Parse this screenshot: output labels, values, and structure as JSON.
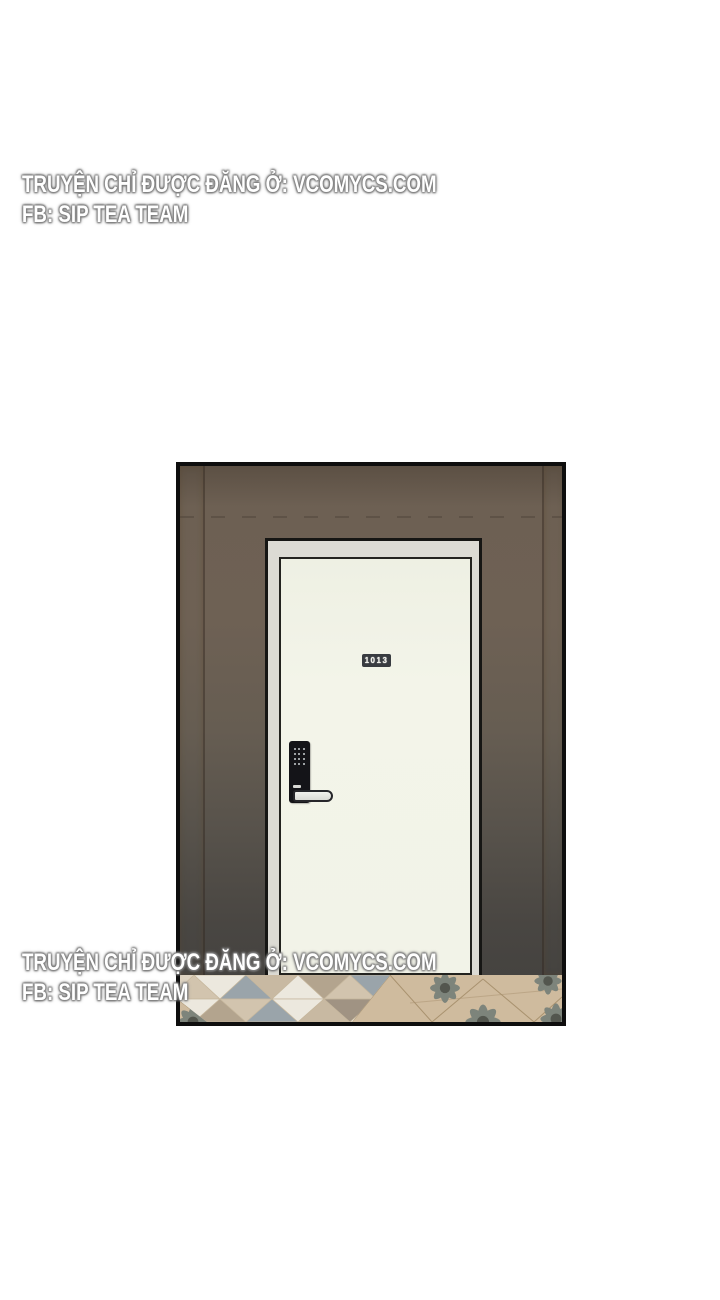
{
  "watermark": {
    "line1": "TRUYỆN CHỈ ĐƯỢC ĐĂNG Ở: VCOMYCS.COM",
    "line2": "FB: SIP TEA TEAM",
    "text_color": "#ffffff",
    "glow_color": "#7d7d7d"
  },
  "panel": {
    "description": "single comic panel: apartment hallway door with keypad lock",
    "border_color": "#0e0e0e",
    "wall_top_color": "#6e6154",
    "wall_bottom_color": "#454340",
    "wood_pillar_light": "#e8dcc6",
    "wood_pillar_mid": "#d5c2a2",
    "wood_pillar_line": "#a8916f",
    "door": {
      "number": "1013",
      "frame_color": "#dcdbd4",
      "door_color": "#f2f3e8",
      "outline_color": "#23231f",
      "plate_bg": "#383b40",
      "plate_text_color": "#f4f4ee",
      "lock_body_color": "#141418",
      "keypad_dot_color": "#c9ced2",
      "handle_color": "#e6e7e3"
    },
    "floor": {
      "tan": "#cfbb9e",
      "grout": "#a9926f",
      "mosaic_white": "#ece8de",
      "mosaic_beige": "#d2c4ae",
      "mosaic_gray_blue": "#9aa4aa",
      "mosaic_taupe": "#b3a48e",
      "mosaic_brown": "#a09383",
      "flower_petal": "#7d847b",
      "flower_center": "#53564e"
    }
  }
}
